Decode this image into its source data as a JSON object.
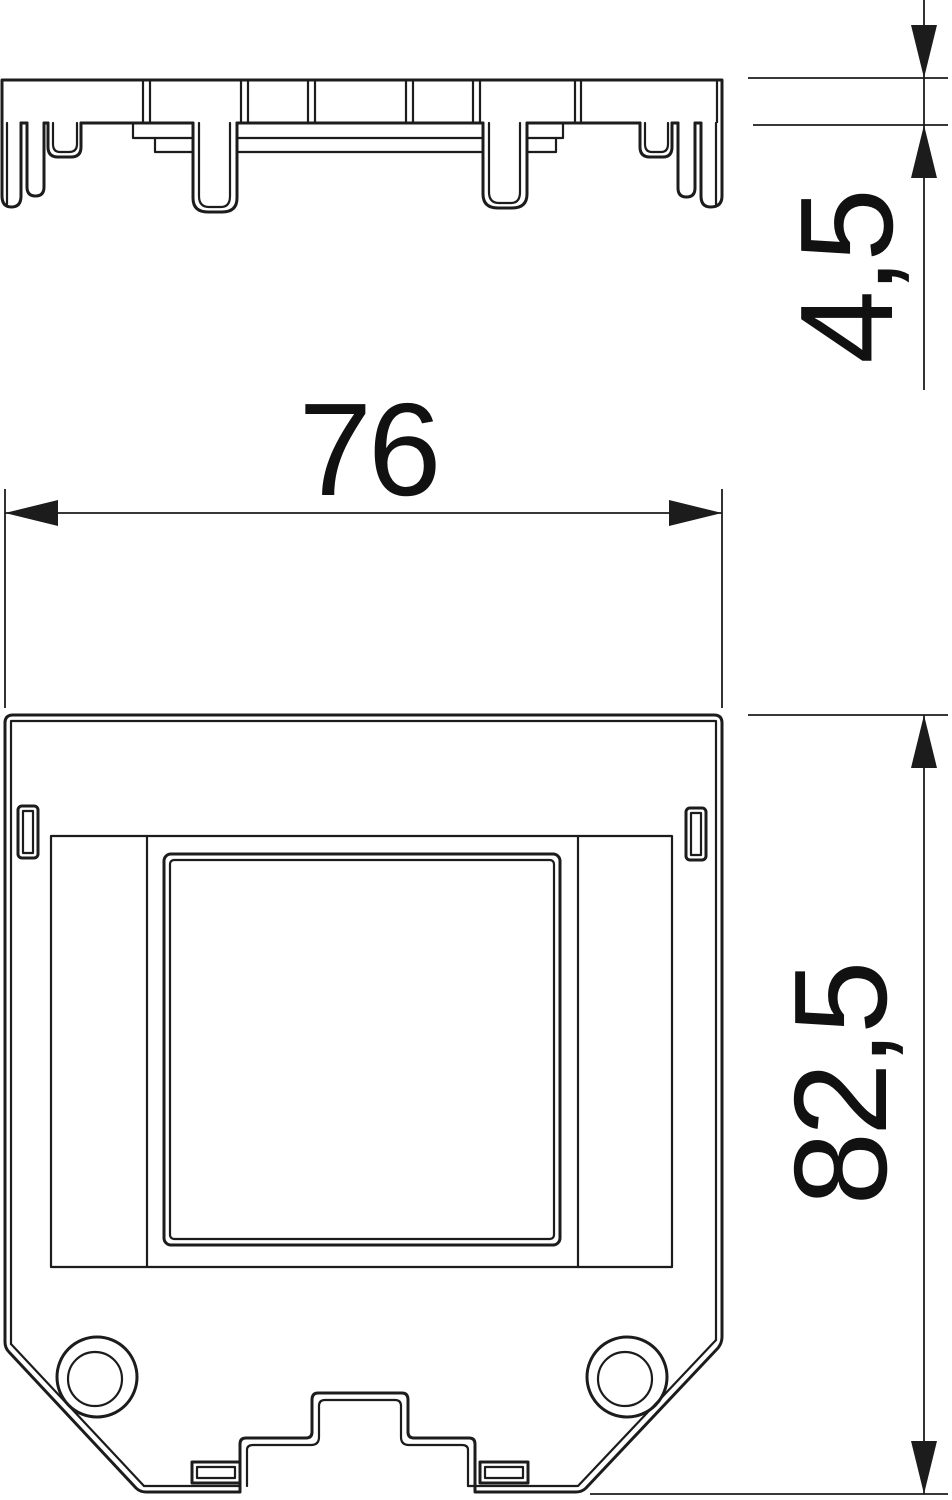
{
  "page": {
    "background": "#ffffff"
  },
  "drawing": {
    "line_color": "#1c1c1c",
    "dimensions": {
      "width": {
        "label": "76"
      },
      "thickness": {
        "label": "4,5"
      },
      "height": {
        "label": "82,5"
      }
    }
  }
}
